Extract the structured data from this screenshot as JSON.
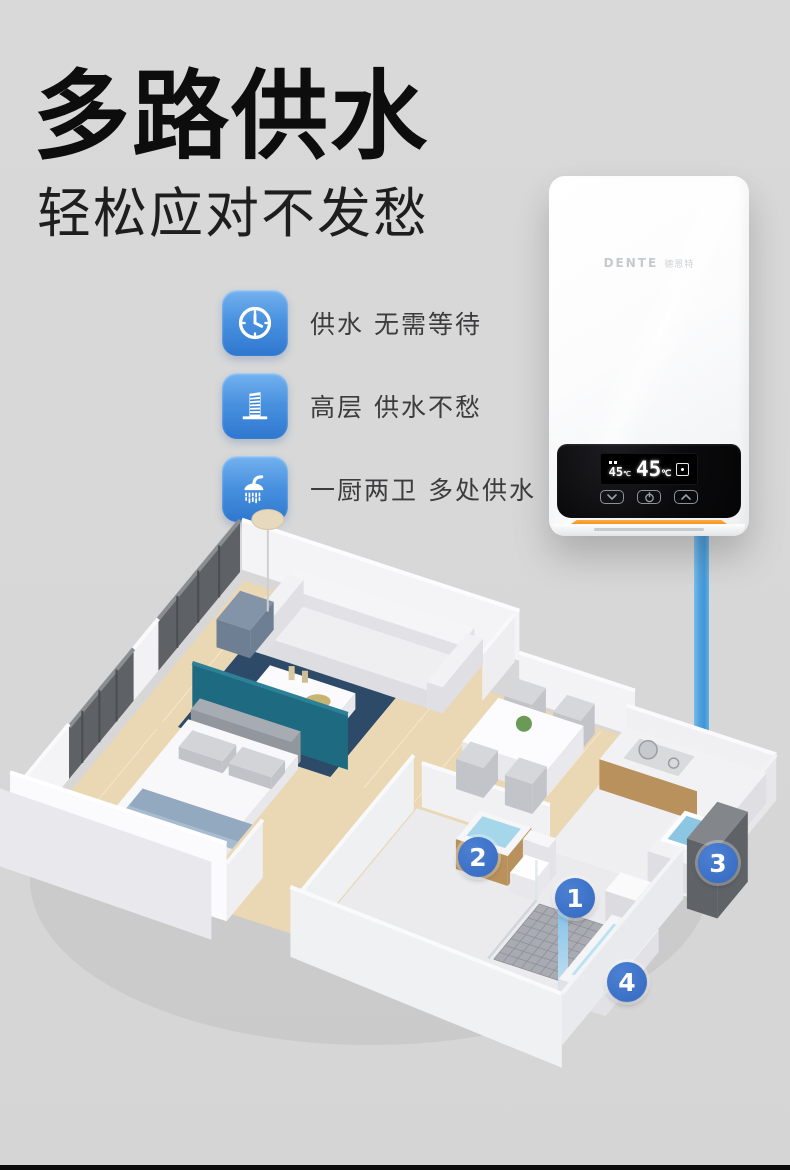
{
  "page": {
    "background": "#d8d8d8",
    "footer_bar_color": "#0b0b0b"
  },
  "header": {
    "title": "多路供水",
    "subtitle": "轻松应对不发愁"
  },
  "features": [
    {
      "icon": "clock-icon",
      "label": "供水 无需等待"
    },
    {
      "icon": "building-icon",
      "label": "高层 供水不愁"
    },
    {
      "icon": "shower-icon",
      "label": "一厨两卫 多处供水"
    }
  ],
  "feature_style": {
    "icon_blue_top": "#74b2ef",
    "icon_blue_bottom": "#2e77cf"
  },
  "heater": {
    "brand": "DENTE",
    "brand_cn": "德恩特",
    "display": {
      "left_value": "45",
      "left_unit": "℃",
      "main_value": "45",
      "main_unit": "℃",
      "mode_icon": "timer-icon"
    },
    "controls": [
      {
        "icon": "chevron-down-icon"
      },
      {
        "icon": "power-icon"
      },
      {
        "icon": "chevron-up-icon"
      }
    ],
    "accent_orange": "#f08318"
  },
  "pipe": {
    "color": "#3d9adc"
  },
  "floorplan": {
    "marker_color": "#3b70c6",
    "markers": [
      {
        "label": "1",
        "point": "shower"
      },
      {
        "label": "2",
        "point": "bathroom-basin"
      },
      {
        "label": "3",
        "point": "kitchen-sink"
      },
      {
        "label": "4",
        "point": "bathtub"
      }
    ]
  }
}
